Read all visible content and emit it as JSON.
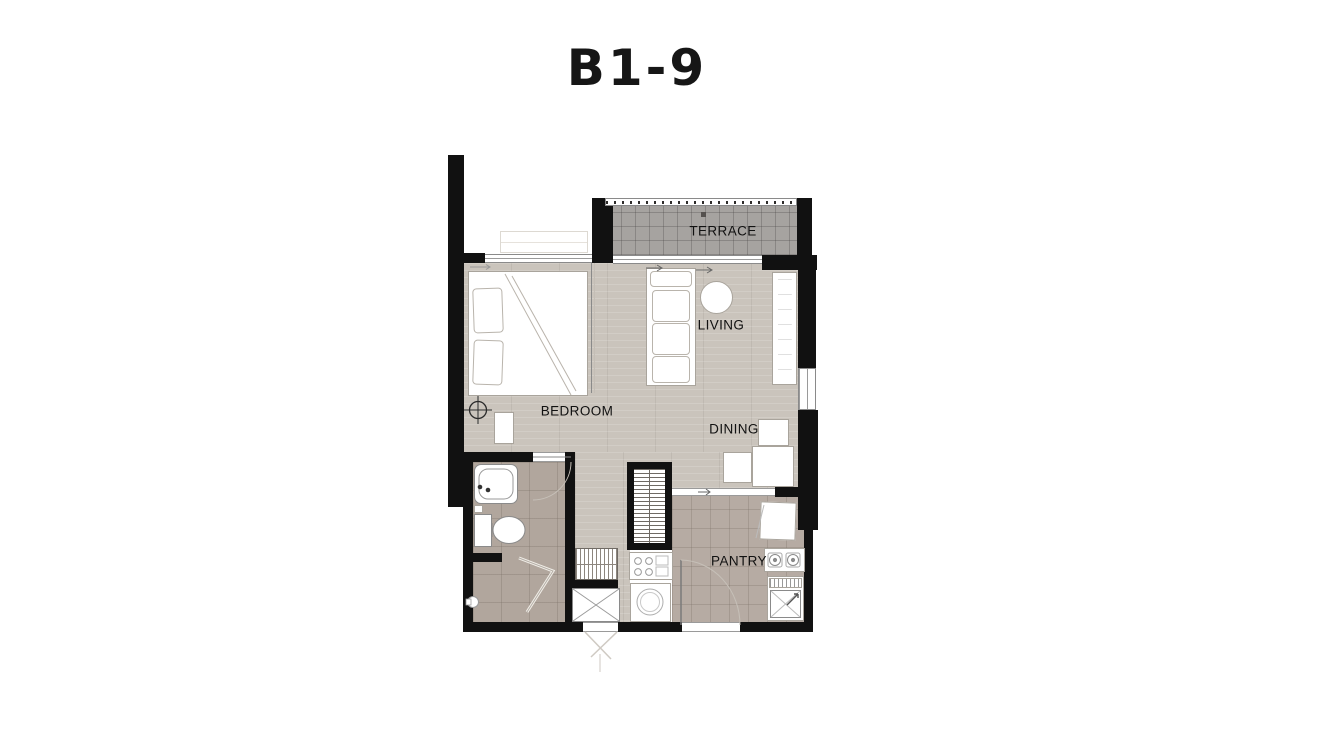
{
  "title": "B1-9",
  "rooms": {
    "terrace": {
      "label": "TERRACE"
    },
    "living": {
      "label": "LIVING"
    },
    "bedroom": {
      "label": "BEDROOM"
    },
    "dining": {
      "label": "DINING"
    },
    "pantry": {
      "label": "PANTRY"
    }
  },
  "colors": {
    "wall": "#111111",
    "wood_floor": "#cac4bc",
    "bathroom_tile": "#b1a69d",
    "pantry_tile": "#b6aba3",
    "terrace_tile": "#a6a3a0",
    "label_text": "#111111",
    "page_background": "#ffffff"
  }
}
